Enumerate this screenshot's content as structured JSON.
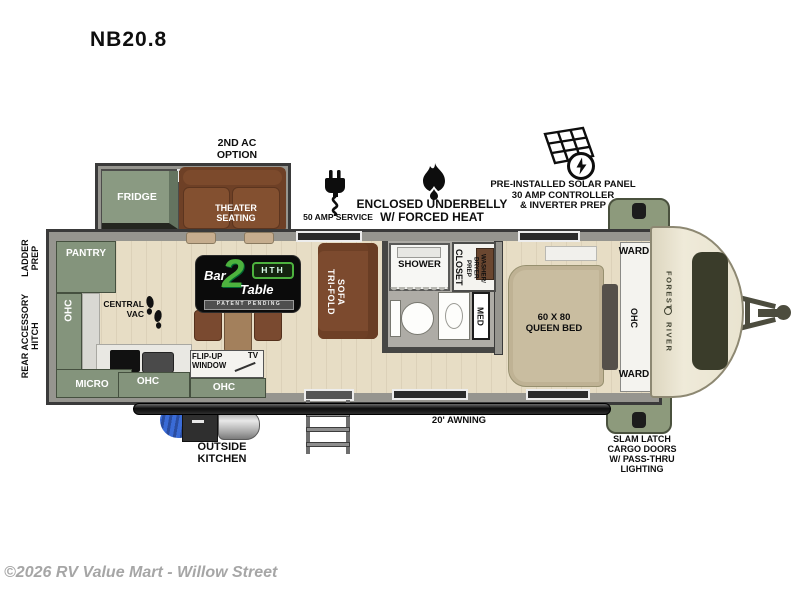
{
  "title": "NB20.8",
  "watermark": "©2026 RV Value Mart - Willow Street",
  "brand": "FOREST RIVER",
  "colors": {
    "cabinet_green": "#84947c",
    "sofa_brown": "#7c4a2e",
    "floor_wood": "#e7ddc5",
    "front_cream": "#ece7d4",
    "logo_green": "#4db23e"
  },
  "callouts": {
    "second_ac": "2ND AC\nOPTION",
    "amp_service": "50 AMP SERVICE",
    "underbelly": "ENCLOSED UNDERBELLY\nW/ FORCED HEAT",
    "solar": "PRE-INSTALLED SOLAR PANEL\n30 AMP CONTROLLER\n& INVERTER PREP",
    "awning": "20' AWNING",
    "outside_kitchen": "OUTSIDE\nKITCHEN",
    "slam_latch": "SLAM LATCH\nCARGO DOORS\nW/ PASS-THRU\nLIGHTING",
    "ladder_prep": "LADDER\nPREP",
    "rear_hitch": "REAR ACCESSORY\nHITCH"
  },
  "rooms": {
    "fridge": "FRIDGE",
    "theater": "THEATER\nSEATING",
    "pantry": "PANTRY",
    "ohc_left": "OHC",
    "ohc_step": "OHC",
    "ohc_bottom": "OHC",
    "micro": "MICRO",
    "central_vac": "CENTRAL\nVAC",
    "flip_up": "FLIP-UP\nWINDOW",
    "tv": "TV",
    "sofa": "TRI-FOLD\nSOFA",
    "shower": "SHOWER",
    "med": "MED",
    "closet": "CLOSET",
    "wd_prep": "WASHER/\nDRYER\nPREP",
    "bed": "60 X 80\nQUEEN BED",
    "ward_top": "WARD",
    "ward_bottom": "WARD",
    "ohc_bed": "OHC"
  },
  "logo": {
    "bar": "Bar",
    "two": "2",
    "table": "Table",
    "badge": "HTH",
    "tagline": "PATENT PENDING"
  }
}
